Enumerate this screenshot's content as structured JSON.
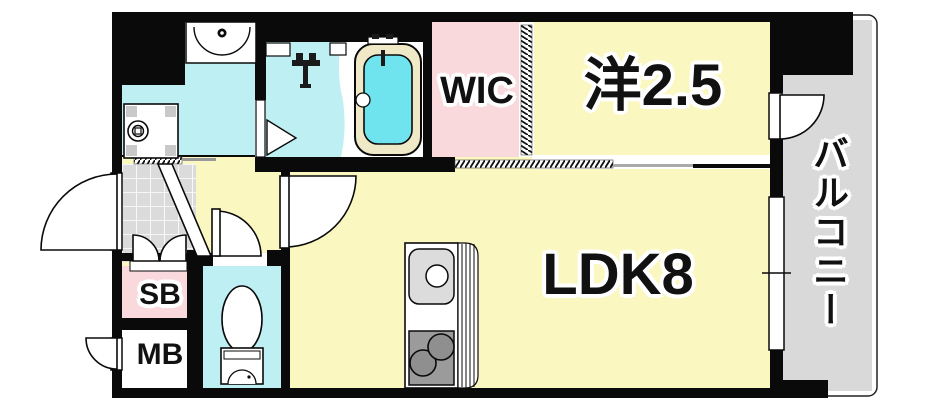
{
  "page": {
    "type": "apartment-floor-plan"
  },
  "rooms": {
    "ldk": {
      "label": "LDK8"
    },
    "western": {
      "label": "洋2.5"
    },
    "wic": {
      "label": "WIC"
    },
    "balcony": {
      "label": "バルコニー"
    },
    "shoe_box": {
      "label": "SB"
    },
    "meter_box": {
      "label": "MB"
    }
  },
  "fixtures": [
    "vanity-sink-icon",
    "washing-machine-pan-icon",
    "shower-faucet-icon",
    "bathtub-icon",
    "toilet-icon",
    "kitchen-sink-icon",
    "stove-icon"
  ],
  "colors": {
    "wall": "#0a0a0a",
    "room_yellow": "#fbf7c0",
    "wet_cyan": "#beeff3",
    "tub_cyan": "#6fe3ee",
    "closet_pink": "#f9d9dc",
    "floor_gray": "#d9d9d9",
    "tub_rim": "#efe9c8",
    "stove_gray": "#9b9b9b"
  }
}
